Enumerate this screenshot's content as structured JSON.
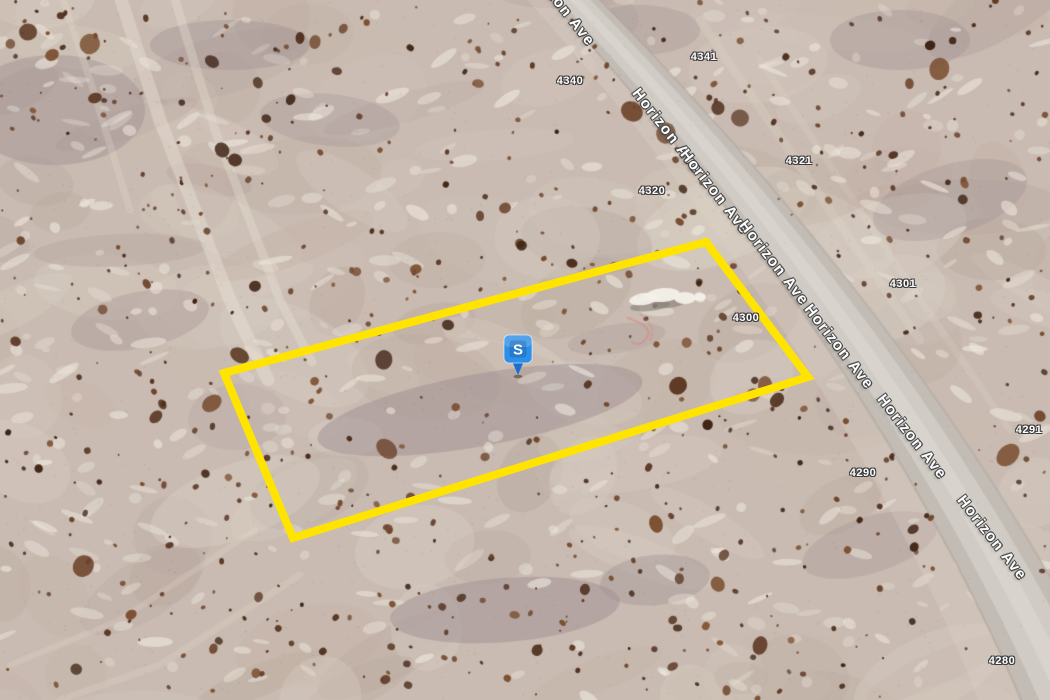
{
  "map": {
    "street_name": "Horizon Ave",
    "street_label_repetitions": 7,
    "marker": {
      "label": "S",
      "color": "#2E8FE8",
      "color_dark": "#1B6FD0"
    },
    "parcel": {
      "outline_color": "#FFE400"
    },
    "addresses": [
      {
        "number": "4341"
      },
      {
        "number": "4340"
      },
      {
        "number": "4321"
      },
      {
        "number": "4320"
      },
      {
        "number": "4301"
      },
      {
        "number": "4300"
      },
      {
        "number": "4291"
      },
      {
        "number": "4290"
      },
      {
        "number": "4280"
      }
    ]
  }
}
